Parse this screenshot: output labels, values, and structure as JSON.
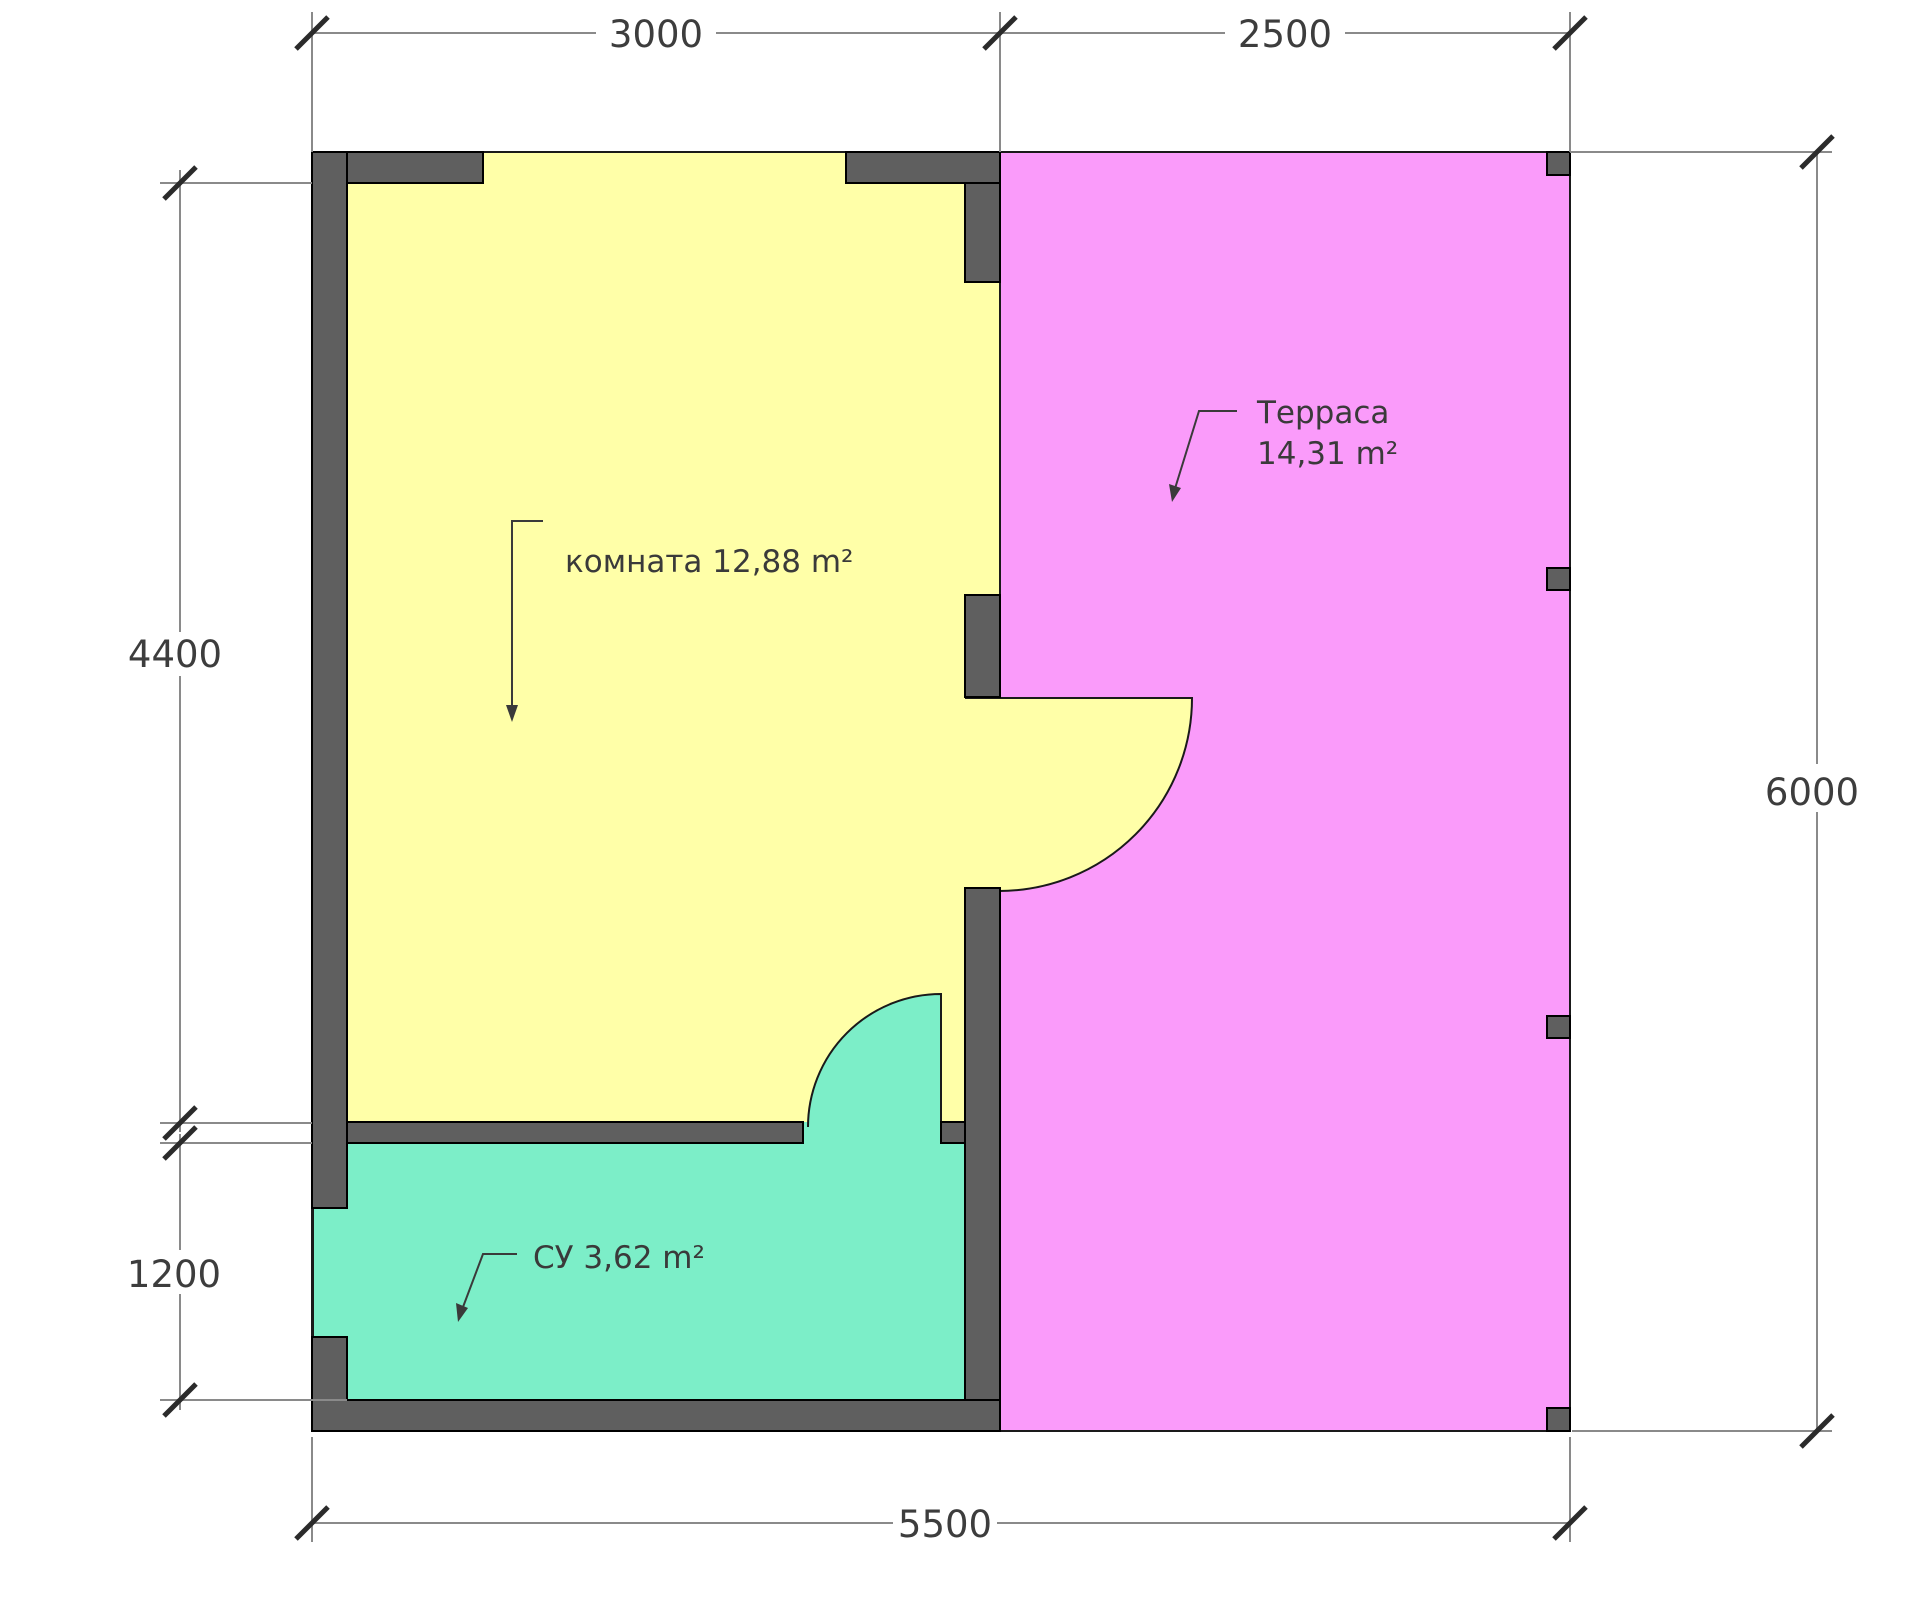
{
  "plan": {
    "rooms": [
      {
        "label": "комната 12,88 m²"
      },
      {
        "line1": "Терраса",
        "line2": "14,31 m²"
      },
      {
        "label": "СУ 3,62 m²"
      }
    ],
    "dimensions": {
      "top_left": "3000",
      "top_right": "2500",
      "left_upper": "4400",
      "left_lower": "1200",
      "right_side": "6000",
      "bottom": "5500"
    },
    "colors": {
      "room": "#ffffa8",
      "terrace": "#fa9bfa",
      "bathroom": "#7ceec8",
      "wall": "#5f5f5f"
    }
  }
}
